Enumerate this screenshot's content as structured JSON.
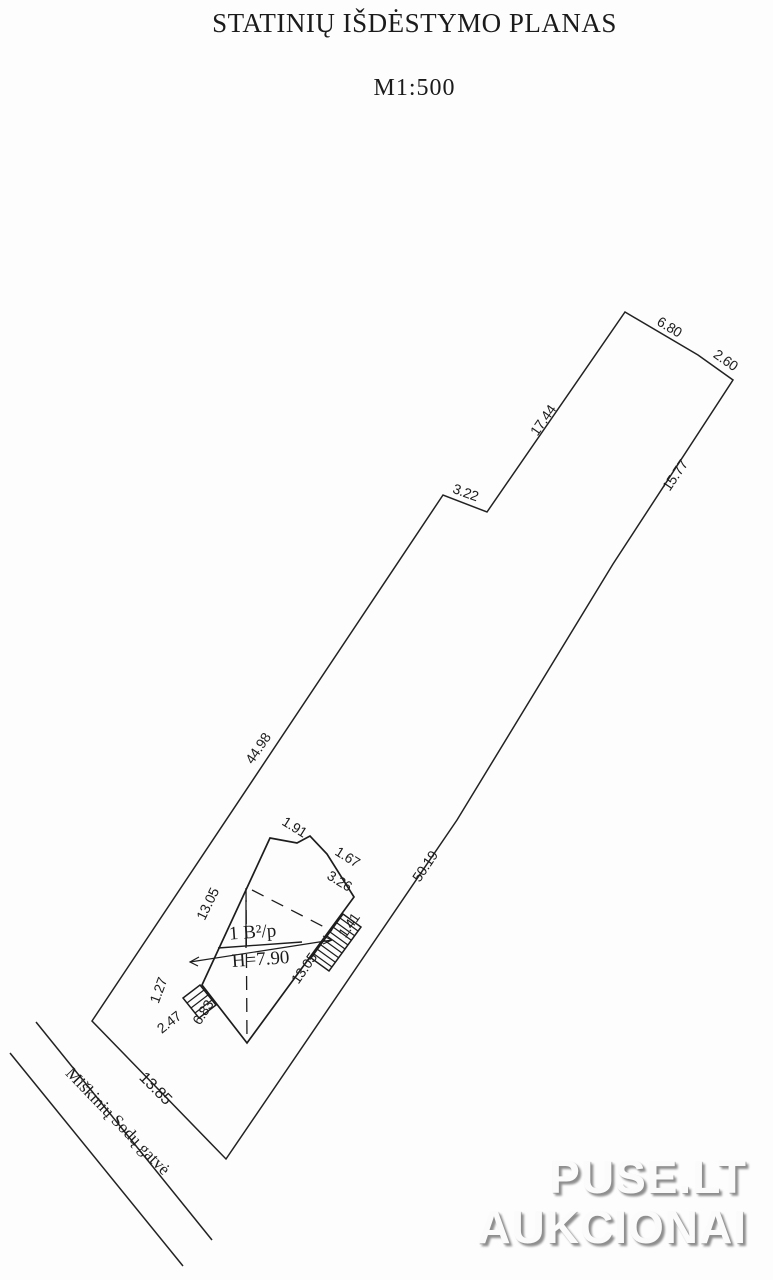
{
  "title": "STATINIŲ IŠDĖSTYMO PLANAS",
  "scale": "M1:500",
  "plan": {
    "boundary_dims": {
      "top1": "6.80",
      "top2": "2.60",
      "right_upper": "15.77",
      "right_lower": "50.19",
      "left_upper": "17.44",
      "step": "3.22",
      "left_lower": "44.98",
      "frontage": "13.85"
    },
    "building": {
      "label": "1 B²/p",
      "height": "H=7.90",
      "dims": {
        "top": "1.91",
        "bay_side": "1.67",
        "bay_top": "3.26",
        "left_wall": "13.05",
        "right_wall": "13.05",
        "stairs": "1.41",
        "porch_side": "1.27",
        "porch_width": "2.47",
        "bottom_wall": "6.83"
      }
    },
    "street": {
      "name": "Miškinių Sodų gatvė"
    }
  },
  "watermark": {
    "line1": "PUSE.LT",
    "line2": "AUKCIONAI"
  }
}
